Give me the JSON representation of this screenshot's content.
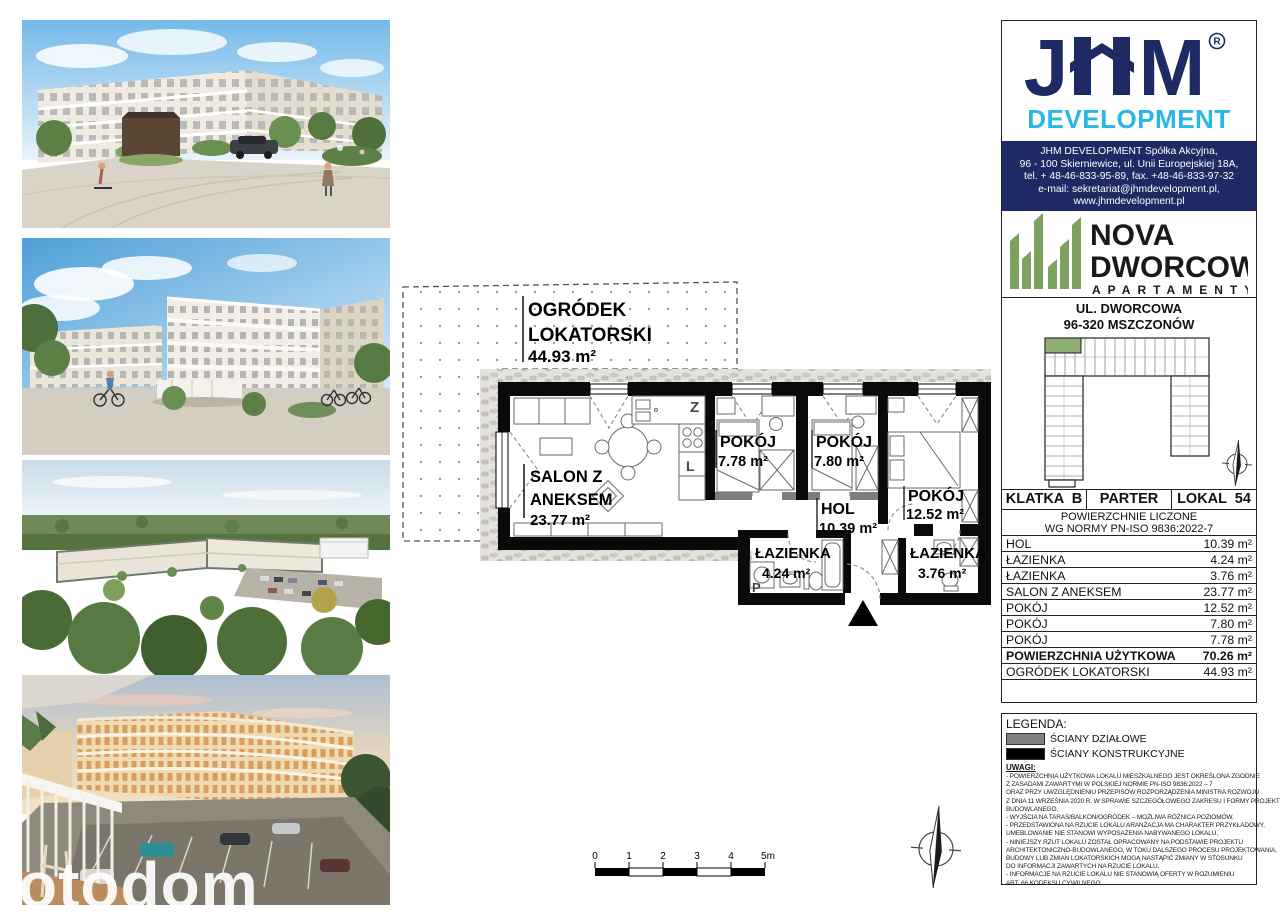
{
  "colors": {
    "navy": "#1d2a63",
    "cyan": "#29b7e6",
    "green": "#7ba25f",
    "green_unit": "#8fae74",
    "wall_black": "#0a0a0a",
    "wall_gray": "#7d7d7d"
  },
  "brand": {
    "j": "J",
    "m": "M",
    "registered": "R",
    "development": "DEVELOPMENT"
  },
  "contact": {
    "lines": [
      "JHM DEVELOPMENT Spółka Akcyjna,",
      "96 - 100 Skierniewice, ul. Unii Europejskiej 18A,",
      "tel. + 48-46-833-95-89, fax. +48-46-833-97-32",
      "e-mail: sekretariat@jhmdevelopment.pl,",
      "www.jhmdevelopment.pl"
    ]
  },
  "project": {
    "name1": "NOVA",
    "name2": "DWORCOWA",
    "subtitle": "APARTAMENTY"
  },
  "address": {
    "line1": "UL. DWORCOWA",
    "line2": "96-320 MSZCZONÓW"
  },
  "unit": {
    "klatka": "KLATKA  B",
    "floor": "PARTER",
    "lokal": "LOKAL  54",
    "norm1": "POWIERZCHNIE LICZONE",
    "norm2": "WG NORMY PN-ISO 9836:2022-7"
  },
  "areas": {
    "rows": [
      {
        "name": "HOL",
        "value": "10.39 m²"
      },
      {
        "name": "ŁAZIENKA",
        "value": "4.24 m²"
      },
      {
        "name": "ŁAZIENKA",
        "value": "3.76 m²"
      },
      {
        "name": "SALON Z ANEKSEM",
        "value": "23.77 m²"
      },
      {
        "name": "POKÓJ",
        "value": "12.52 m²"
      },
      {
        "name": "POKÓJ",
        "value": "7.80 m²"
      },
      {
        "name": "POKÓJ",
        "value": "7.78 m²"
      },
      {
        "name": "POWIERZCHNIA UŻYTKOWA",
        "value": "70.26 m²"
      },
      {
        "name": "OGRÓDEK LOKATORSKI",
        "value": "44.93 m²"
      }
    ]
  },
  "legend": {
    "title": "LEGENDA:",
    "items": [
      {
        "label": "ŚCIANY DZIAŁOWE",
        "color": "#808080"
      },
      {
        "label": "ŚCIANY KONSTRUKCYJNE",
        "color": "#000000"
      }
    ]
  },
  "uwagi": {
    "title": "UWAGI:",
    "lines": [
      "-  POWIERZCHNIA UŻYTKOWA LOKALU MIESZKALNEGO JEST OKREŚLONA ZGODNIE",
      "Z ZASADAMI ZAWARTYMI W POLSKIEJ NORMIE PN-ISO 9836:2022 – 7",
      "ORAZ PRZY UWZGLĘDNIENIU PRZEPISÓW ROZPORZĄDZENIA MINISTRA ROZWOJU",
      "Z DNIA 11 WRZEŚNIA 2020 R. W SPRAWIE SZCZEGÓŁOWEGO ZAKRESU I FORMY PROJEKTU",
      "BUDOWLANEGO,",
      "-  WYJŚCIA NA TARAS/BALKON/OGRÓDEK – MOŻLIWA RÓŻNICA POZIOMÓW,",
      "-  PRZEDSTAWIONA NA RZUCIE LOKALU ARANŻACJA MA CHARAKTER PRZYKŁADOWY,",
      "UMEBLOWANIE NIE STANOWI WYPOSAŻENIA NABYWANEGO LOKALU,",
      "-  NINIEJSZY RZUT LOKALU ZOSTAŁ OPRACOWANY NA PODSTAWIE PROJEKTU",
      "ARCHITEKTONICZNO-BUDOWLANEGO, W TOKU DALSZEGO PROCESU PROJEKTOWANIA,",
      "BUDOWY LUB ZMIAN LOKATORSKICH MOGĄ NASTĄPIĆ ZMIANY W STOSUNKU",
      "DO INFORMACJI ZAWARTYCH NA RZUCIE LOKALU,",
      "-  INFORMACJE NA RZUCIE LOKALU NIE STANOWIĄ OFERTY W ROZUMIENIU",
      "ART. 66 KODEKSU CYWILNEGO"
    ]
  },
  "floorplan": {
    "garden": {
      "line1": "OGRÓDEK",
      "line2": "LOKATORSKI",
      "area": "44.93 m²"
    },
    "salon": {
      "line1": "SALON Z",
      "line2": "ANEKSEM",
      "area": "23.77 m²"
    },
    "room1": {
      "name": "POKÓJ",
      "area": "7.78 m²"
    },
    "room2": {
      "name": "POKÓJ",
      "area": "7.80 m²"
    },
    "room3": {
      "name": "POKÓJ",
      "area": "12.52 m²"
    },
    "hol": {
      "name": "HOL",
      "area": "10.39 m²"
    },
    "bath1": {
      "name": "ŁAZIENKA",
      "area": "4.24 m²"
    },
    "bath2": {
      "name": "ŁAZIENKA",
      "area": "3.76 m²"
    },
    "marks": {
      "sink": "Z",
      "fridge": "L",
      "washer": "P"
    },
    "scale": {
      "t0": "0",
      "t1": "1",
      "t2": "2",
      "t3": "3",
      "t4": "4",
      "t5": "5m"
    }
  },
  "watermark": "otodom"
}
